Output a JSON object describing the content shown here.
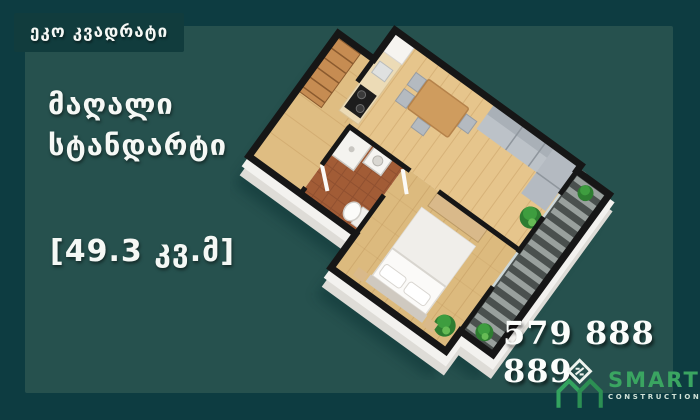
{
  "badge": {
    "label": "ეკო კვადრატი"
  },
  "headline": {
    "line1": "მაღალი",
    "line2": "სტანდარტი"
  },
  "area": {
    "label": "[49.3 კვ.მ]"
  },
  "phone": {
    "number": "579 888 889"
  },
  "logo": {
    "name": "SMART",
    "subtitle": "CONSTRUCTION",
    "mark": "sm-monogram-icon"
  },
  "floorplan": {
    "type": "3d-isometric-apartment-render",
    "rooms": [
      "kitchen-living-room",
      "bedroom",
      "bathroom",
      "hallway",
      "balcony"
    ],
    "objects": [
      "kitchen-counter",
      "fridge",
      "stove",
      "dining-table",
      "chairs",
      "sofa",
      "plants",
      "bed",
      "wardrobe",
      "toilet",
      "shower",
      "washing-machine",
      "closet",
      "balcony-decking"
    ]
  },
  "colors": {
    "background": "#0d3c41",
    "panel": "#26514e",
    "badge": "#113c3d",
    "text": "#f5f8f5",
    "logo_green": "#3aa561",
    "floor_wood": "#e6c58c",
    "wall_top": "#161616",
    "wall_side": "#f3f2ef",
    "bathroom_tile": "#a25c36",
    "balcony_deck": "#4a504e"
  }
}
